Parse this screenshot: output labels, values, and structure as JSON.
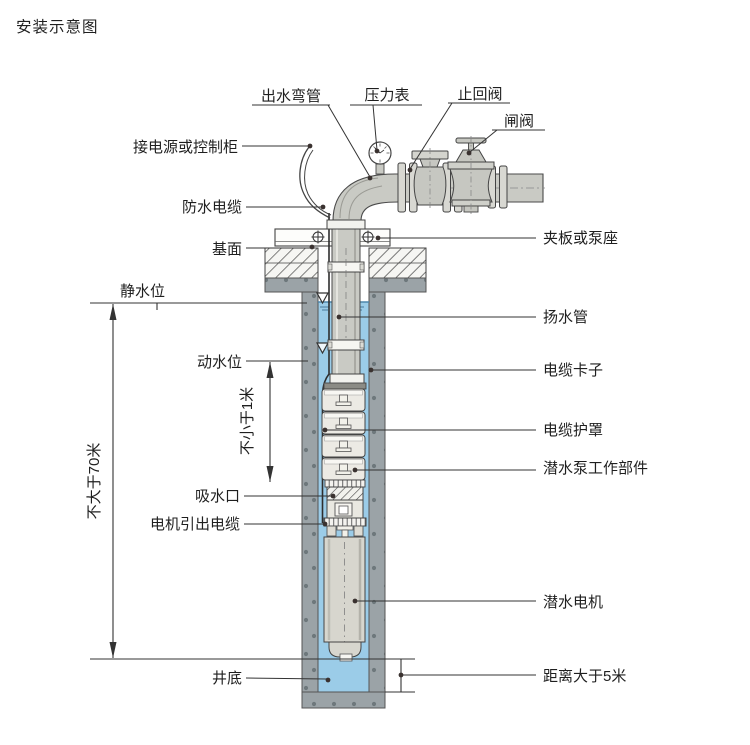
{
  "title": "安装示意图",
  "labels": {
    "outlet_elbow": "出水弯管",
    "pressure_gauge": "压力表",
    "check_valve": "止回阀",
    "gate_valve": "闸阀",
    "power_or_control_cabinet": "接电源或控制柜",
    "waterproof_cable": "防水电缆",
    "base_surface": "基面",
    "static_water_level": "静水位",
    "dynamic_water_level": "动水位",
    "suction_inlet": "吸水口",
    "motor_lead_cable": "电机引出电缆",
    "well_bottom": "井底",
    "clamp_or_pump_seat": "夹板或泵座",
    "riser_pipe": "扬水管",
    "cable_clamp": "电缆卡子",
    "cable_guard": "电缆护罩",
    "pump_working_parts": "潜水泵工作部件",
    "submersible_motor": "潜水电机",
    "distance_gt_5m": "距离大于5米"
  },
  "dimensions": {
    "max_depth": "不大于70米",
    "min_clearance": "不小于1米"
  },
  "colors": {
    "water": "#9bcce8",
    "water_surface": "#4d86ab",
    "casing_gray": "#9ba3a7",
    "casing_speckle": "#6e787c",
    "pipe_gray": "#c9cac4",
    "pump_body": "#eceae4",
    "motor_body": "#d7d6ce",
    "line": "#333333"
  }
}
